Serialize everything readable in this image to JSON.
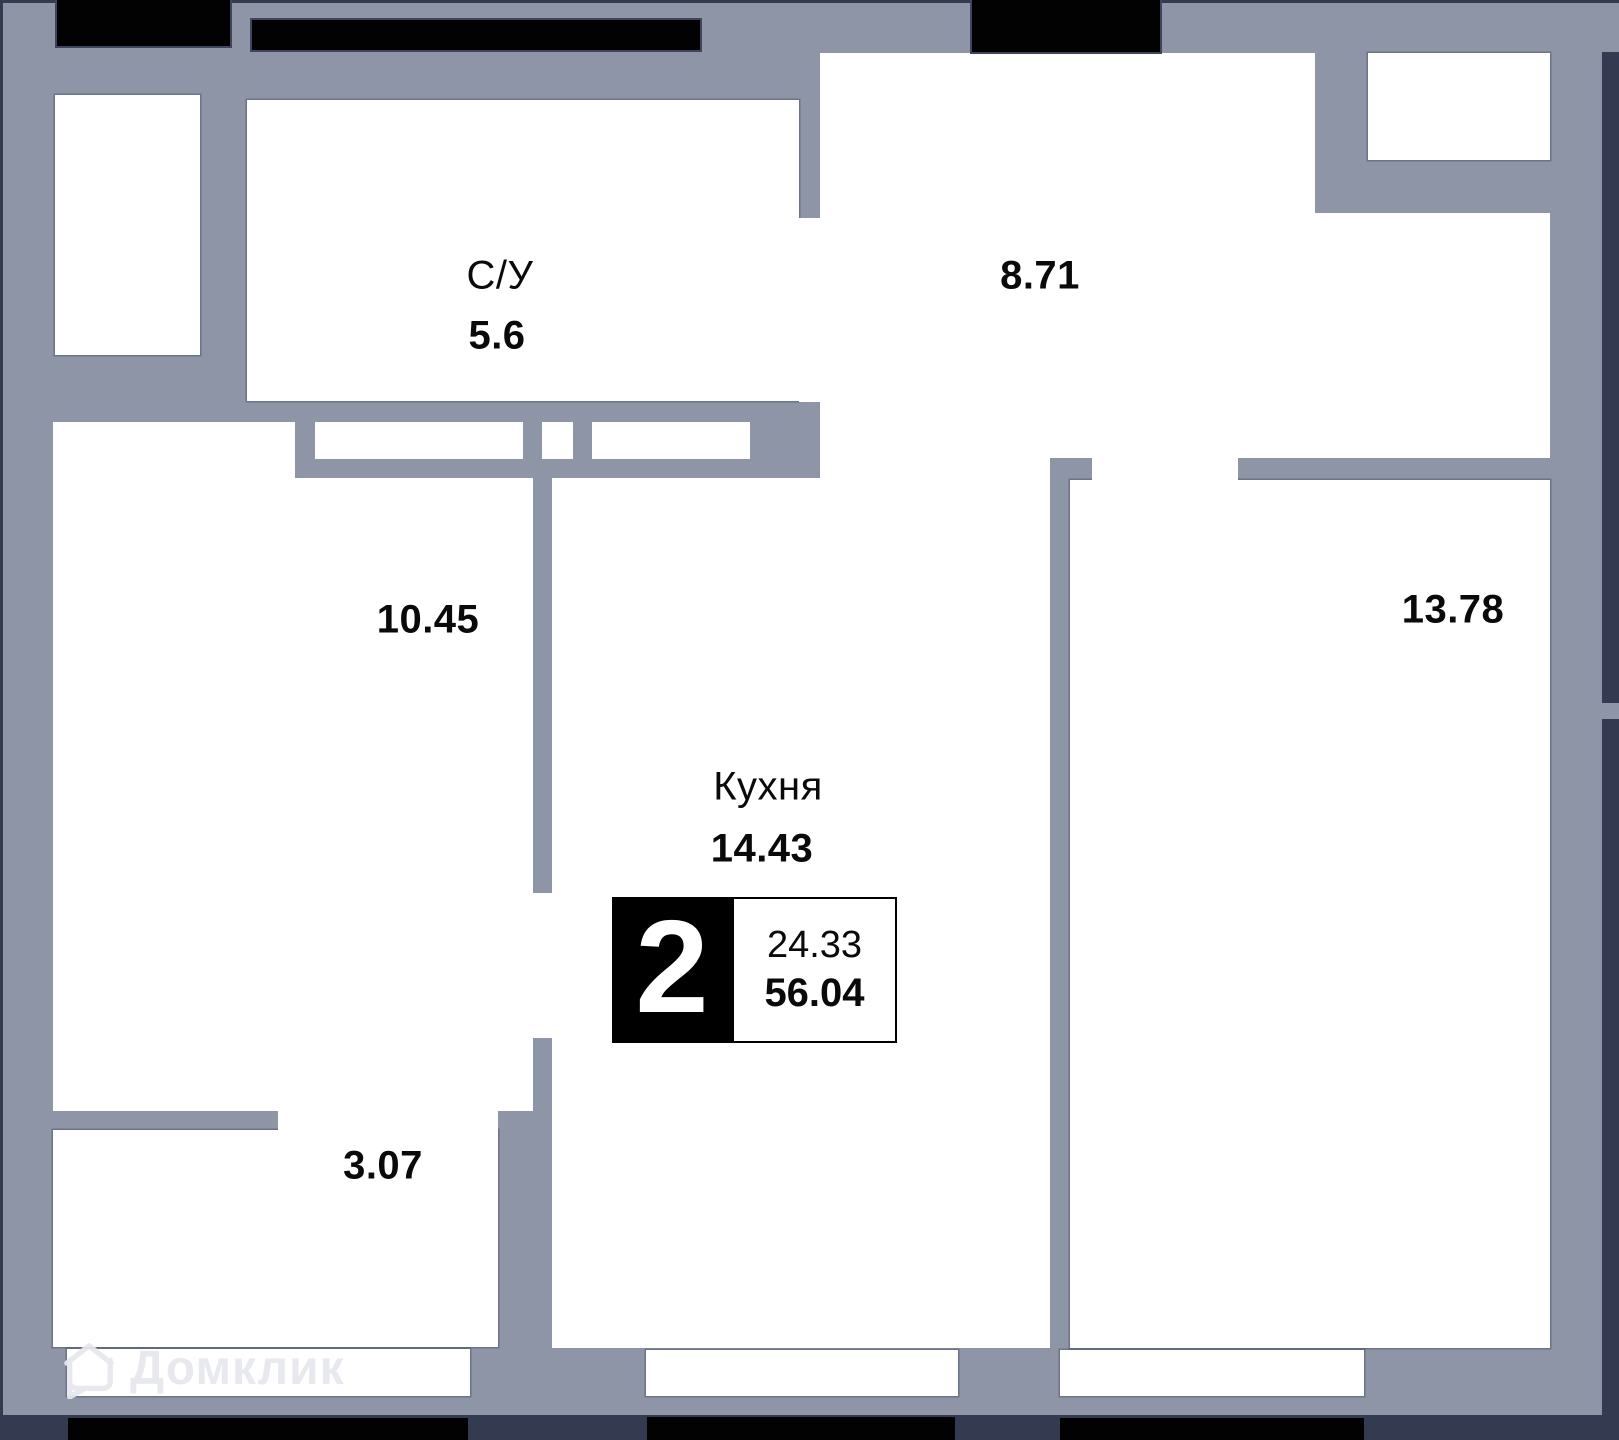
{
  "plan": {
    "rooms": [
      {
        "id": "bathroom",
        "label": "С/У",
        "area": "5.6"
      },
      {
        "id": "hallway",
        "label": "",
        "area": "8.71"
      },
      {
        "id": "room-a",
        "label": "",
        "area": "10.45"
      },
      {
        "id": "room-b",
        "label": "",
        "area": "13.78"
      },
      {
        "id": "kitchen",
        "label": "Кухня",
        "area": "14.43"
      },
      {
        "id": "balcony",
        "label": "",
        "area": "3.07"
      }
    ],
    "badge": {
      "room_count": "2",
      "living_area": "24.33",
      "total_area": "56.04"
    },
    "watermark": {
      "brand": "Домклик"
    },
    "colors": {
      "wall": "#8e95a7",
      "outline": "#343b50",
      "window_bar": "#020202",
      "room_fill": "#ffffff",
      "text": "#0a0a0a",
      "badge_bg": "#000000",
      "badge_text": "#ffffff"
    }
  }
}
